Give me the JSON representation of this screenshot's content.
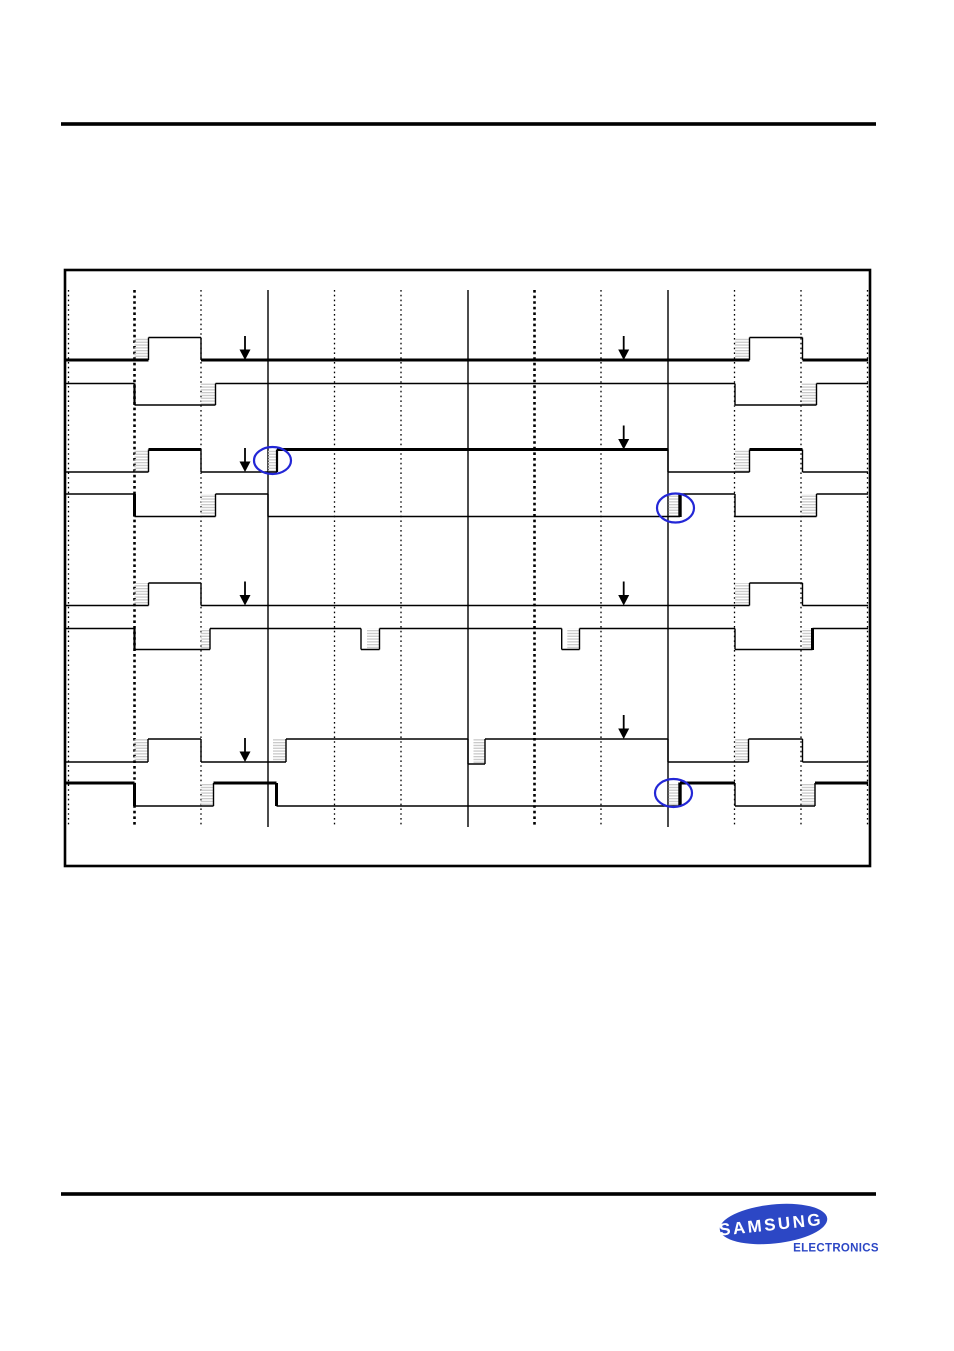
{
  "page": {
    "width": 954,
    "height": 1351,
    "background": "#ffffff"
  },
  "colors": {
    "line": "#000000",
    "hatch_stripe": "#c9c9c9",
    "highlight_blue": "#2327d6",
    "logo_blue": "#2c47c5",
    "logo_text": "#ffffff"
  },
  "rules": {
    "header": {
      "x1": 61,
      "x2": 876,
      "y": 124,
      "thickness": 3.6
    },
    "footer": {
      "x1": 61,
      "x2": 876,
      "y": 1194,
      "thickness": 3.6
    }
  },
  "diagram": {
    "box": {
      "x": 65,
      "y": 270,
      "width": 805,
      "height": 596,
      "border": 2.6
    },
    "grid": {
      "y1": 290,
      "y2": 827,
      "verticals": [
        {
          "x": 68.5,
          "style": "dotted"
        },
        {
          "x": 134.5,
          "style": "dotted-bold"
        },
        {
          "x": 201,
          "style": "dotted"
        },
        {
          "x": 268,
          "style": "solid"
        },
        {
          "x": 334.5,
          "style": "dotted"
        },
        {
          "x": 401,
          "style": "dotted"
        },
        {
          "x": 468,
          "style": "solid"
        },
        {
          "x": 534.5,
          "style": "dotted-bold"
        },
        {
          "x": 601,
          "style": "dotted"
        },
        {
          "x": 668,
          "style": "solid"
        },
        {
          "x": 734.5,
          "style": "dotted"
        },
        {
          "x": 801,
          "style": "dotted"
        },
        {
          "x": 867.5,
          "style": "dotted"
        }
      ]
    },
    "rows": [
      {
        "name": "row-1",
        "h": [
          [
            65,
            148.5,
            360,
            3
          ],
          [
            148.5,
            201,
            337.5,
            1.4
          ],
          [
            201,
            749.5,
            360,
            3
          ],
          [
            749.5,
            802.5,
            337.5,
            1.4
          ],
          [
            802.5,
            868,
            360,
            3
          ]
        ],
        "v": [
          [
            148.5,
            337.5,
            360,
            1.4
          ],
          [
            201,
            337.5,
            360,
            1.4
          ],
          [
            749.5,
            337.5,
            360,
            1.4
          ],
          [
            802.5,
            337.5,
            360,
            1.4
          ]
        ],
        "hatch": [
          [
            134.5,
            14,
            337.5,
            360
          ],
          [
            735,
            14.5,
            337.5,
            360
          ]
        ]
      },
      {
        "name": "row-2",
        "h": [
          [
            65,
            134.5,
            383.5,
            1.4
          ],
          [
            134.5,
            215.5,
            405,
            1.4
          ],
          [
            215.5,
            735,
            383.5,
            1.4
          ],
          [
            735,
            816.5,
            405,
            1.4
          ],
          [
            816.5,
            868,
            383.5,
            1.4
          ]
        ],
        "v": [
          [
            134.5,
            383.5,
            405,
            2.2
          ],
          [
            215.5,
            383.5,
            405,
            1.4
          ],
          [
            735,
            383.5,
            405,
            1.4
          ],
          [
            816.5,
            383.5,
            405,
            1.4
          ]
        ],
        "hatch": [
          [
            200.7,
            14.8,
            383.5,
            405
          ],
          [
            801.7,
            14.8,
            383.5,
            405
          ]
        ]
      },
      {
        "name": "row-3",
        "h": [
          [
            65,
            148.5,
            472,
            1.4
          ],
          [
            148.5,
            201,
            449.5,
            3
          ],
          [
            201,
            277,
            472,
            1.4
          ],
          [
            277,
            668,
            449.5,
            3
          ],
          [
            668,
            749.5,
            472,
            1.4
          ],
          [
            749.5,
            802.5,
            449.5,
            3
          ],
          [
            802.5,
            868,
            472,
            1.4
          ]
        ],
        "v": [
          [
            148.5,
            449.5,
            472,
            1.4
          ],
          [
            201,
            449.5,
            472,
            1.4
          ],
          [
            277,
            449.5,
            472,
            2.2
          ],
          [
            668,
            449.5,
            472,
            1.4
          ],
          [
            749.5,
            449.5,
            472,
            1.4
          ],
          [
            802.5,
            449.5,
            472,
            1.4
          ]
        ],
        "hatch": [
          [
            134.5,
            14,
            449.5,
            472
          ],
          [
            268,
            9,
            449.5,
            472
          ],
          [
            735,
            14.5,
            449.5,
            472
          ]
        ]
      },
      {
        "name": "row-4",
        "h": [
          [
            65,
            134.5,
            494,
            1.4
          ],
          [
            134.5,
            215.5,
            516.5,
            1.4
          ],
          [
            215.5,
            268,
            494,
            1.4
          ],
          [
            268,
            680,
            516.5,
            1.4
          ],
          [
            680,
            735,
            494,
            1.4
          ],
          [
            735,
            816.5,
            516.5,
            1.4
          ],
          [
            816.5,
            868,
            494,
            1.4
          ]
        ],
        "v": [
          [
            134.5,
            494,
            516.5,
            3
          ],
          [
            215.5,
            494,
            516.5,
            1.4
          ],
          [
            268,
            494,
            516.5,
            1.4
          ],
          [
            680,
            493.5,
            517,
            3.4
          ],
          [
            735,
            494,
            516.5,
            1.4
          ],
          [
            816.5,
            494,
            516.5,
            1.4
          ]
        ],
        "hatch": [
          [
            200.7,
            14.8,
            494,
            516.5
          ],
          [
            668.5,
            11.5,
            494,
            516.5
          ],
          [
            801.7,
            14.8,
            494,
            516.5
          ]
        ]
      },
      {
        "name": "row-5",
        "h": [
          [
            65,
            148.5,
            605.5,
            1.4
          ],
          [
            148.5,
            201,
            583,
            1.4
          ],
          [
            201,
            749.5,
            605.5,
            1.4
          ],
          [
            749.5,
            802.5,
            583,
            1.4
          ],
          [
            802.5,
            868,
            605.5,
            1.4
          ]
        ],
        "v": [
          [
            148.5,
            583,
            605.5,
            1.4
          ],
          [
            201,
            583,
            605.5,
            1.4
          ],
          [
            749.5,
            583,
            605.5,
            1.4
          ],
          [
            802.5,
            583,
            605.5,
            1.4
          ]
        ],
        "hatch": [
          [
            134.5,
            14,
            583,
            605.5
          ],
          [
            735,
            14.5,
            583,
            605.5
          ]
        ]
      },
      {
        "name": "row-6",
        "h": [
          [
            65,
            134.5,
            628.5,
            1.4
          ],
          [
            134.5,
            210,
            649.5,
            1.4
          ],
          [
            210,
            361,
            628.5,
            1.4
          ],
          [
            361,
            379.5,
            649.5,
            1.4
          ],
          [
            379.5,
            561.7,
            628.5,
            1.4
          ],
          [
            561.7,
            579.5,
            649.5,
            1.4
          ],
          [
            579.5,
            735,
            628.5,
            1.4
          ],
          [
            735,
            812.5,
            649.5,
            1.4
          ],
          [
            812.5,
            868,
            628.5,
            1.4
          ]
        ],
        "v": [
          [
            134.5,
            628.5,
            649.5,
            2.2
          ],
          [
            210,
            628.5,
            649.5,
            1.4
          ],
          [
            361,
            628.5,
            649.5,
            1.4
          ],
          [
            379.5,
            628.5,
            649.5,
            1.4
          ],
          [
            561.7,
            628.5,
            649.5,
            1.4
          ],
          [
            579.5,
            628.5,
            649.5,
            1.4
          ],
          [
            735,
            628.5,
            649.5,
            1.4
          ],
          [
            812.5,
            628,
            650,
            3
          ]
        ],
        "hatch": [
          [
            200.7,
            9.3,
            628.5,
            649.5
          ],
          [
            367,
            12.5,
            628.5,
            649.5
          ],
          [
            567.3,
            12.2,
            628.5,
            649.5
          ],
          [
            802.3,
            10.2,
            628.5,
            649.5
          ]
        ]
      },
      {
        "name": "row-7",
        "h": [
          [
            65,
            148,
            762,
            1.4
          ],
          [
            148,
            201,
            739,
            1.4
          ],
          [
            201,
            286,
            762,
            1.4
          ],
          [
            286,
            468,
            739,
            1.4
          ],
          [
            468,
            485,
            764,
            1.4
          ],
          [
            485,
            668,
            739,
            1.4
          ],
          [
            668,
            748.5,
            762,
            1.4
          ],
          [
            748.5,
            802.5,
            739,
            1.4
          ],
          [
            802.5,
            868,
            762,
            1.4
          ]
        ],
        "v": [
          [
            148,
            739,
            762,
            1.4
          ],
          [
            201,
            739,
            762,
            1.4
          ],
          [
            286,
            739,
            762,
            1.4
          ],
          [
            468,
            739,
            764,
            1.4
          ],
          [
            485,
            739,
            764,
            1.4
          ],
          [
            668,
            739,
            762,
            1.4
          ],
          [
            748.5,
            739,
            762,
            1.4
          ],
          [
            802.5,
            739,
            762,
            1.4
          ]
        ],
        "hatch": [
          [
            134.5,
            13.5,
            739,
            762
          ],
          [
            273,
            13,
            739,
            762
          ],
          [
            473.5,
            11,
            739,
            764
          ],
          [
            735,
            13.5,
            739,
            762
          ]
        ]
      },
      {
        "name": "row-8",
        "h": [
          [
            65,
            134.5,
            783,
            3
          ],
          [
            134.5,
            213.5,
            806,
            1.4
          ],
          [
            213.5,
            276.5,
            783,
            3
          ],
          [
            276.5,
            680,
            806,
            1.4
          ],
          [
            680,
            735,
            783,
            3
          ],
          [
            735,
            815,
            806,
            1.4
          ],
          [
            815,
            868,
            783,
            3
          ]
        ],
        "v": [
          [
            134.5,
            783,
            806,
            3
          ],
          [
            213.5,
            783,
            806,
            1.4
          ],
          [
            276.5,
            783,
            806,
            3
          ],
          [
            680,
            782.5,
            806.5,
            3.4
          ],
          [
            735,
            783,
            806,
            1.4
          ],
          [
            815,
            783,
            806,
            1.4
          ]
        ],
        "hatch": [
          [
            200.7,
            12.8,
            783,
            806
          ],
          [
            668.5,
            11.5,
            783,
            806
          ],
          [
            801.7,
            13.3,
            783,
            806
          ]
        ]
      }
    ],
    "arrows": [
      {
        "x": 245,
        "tip": 360
      },
      {
        "x": 623.7,
        "tip": 360
      },
      {
        "x": 245,
        "tip": 472
      },
      {
        "x": 623.7,
        "tip": 449.5
      },
      {
        "x": 245,
        "tip": 605.5
      },
      {
        "x": 623.7,
        "tip": 605.5
      },
      {
        "x": 245,
        "tip": 762
      },
      {
        "x": 623.7,
        "tip": 739
      }
    ],
    "highlight_ellipses": [
      {
        "cx": 272.5,
        "cy": 460.5,
        "rx": 18.5,
        "ry": 13.5
      },
      {
        "cx": 675.5,
        "cy": 508,
        "rx": 18.5,
        "ry": 14.5
      },
      {
        "cx": 673.5,
        "cy": 793,
        "rx": 18.5,
        "ry": 14
      }
    ]
  },
  "logo": {
    "ellipse": {
      "cx": 773.5,
      "cy": 1224,
      "rx": 54,
      "ry": 19.5,
      "rotate": -6
    },
    "wordmark": "SAMSUNG",
    "wordmark_pos": {
      "x": 771,
      "y": 1230,
      "size": 17,
      "spacing": 2.5
    },
    "subtitle": "ELECTRONICS",
    "subtitle_pos": {
      "x": 836,
      "y": 1251.5,
      "size": 11.5,
      "spacing": 0.3
    }
  }
}
